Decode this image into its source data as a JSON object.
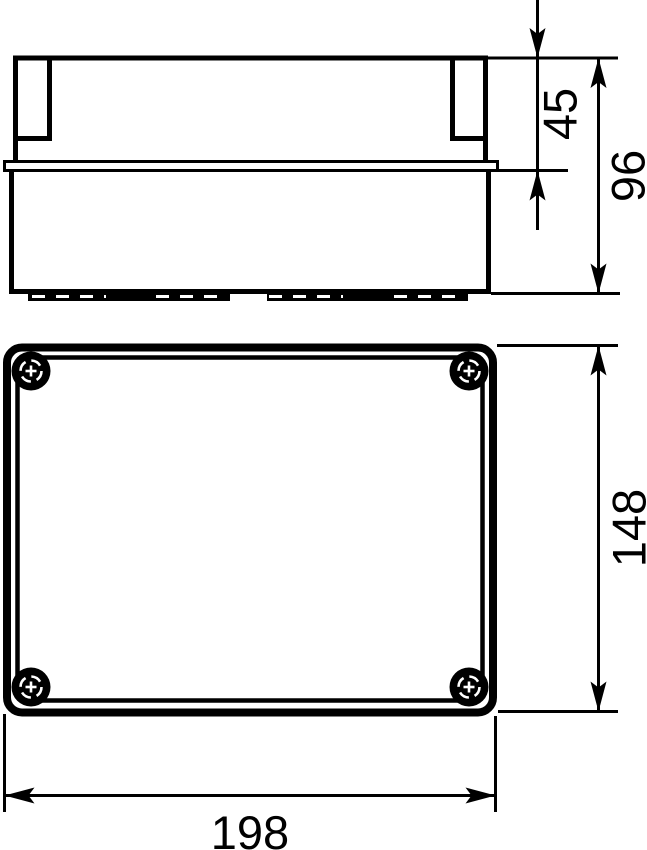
{
  "drawing": {
    "background_color": "#ffffff",
    "line_color": "#000000",
    "dimensions": {
      "lid_height": "45",
      "total_height": "96",
      "depth": "148",
      "width": "198"
    }
  }
}
